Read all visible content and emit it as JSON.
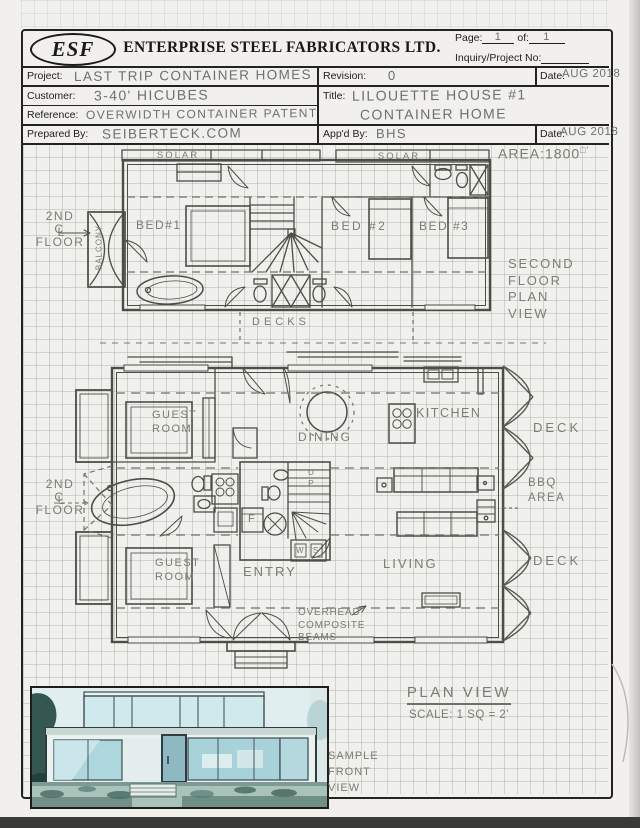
{
  "header": {
    "logo": "ESF",
    "company": "ENTERPRISE STEEL FABRICATORS LTD.",
    "page_label": "Page:",
    "page_value": "1",
    "of_label": "of:",
    "of_value": "1",
    "inquiry_label": "Inquiry/Project  No:"
  },
  "title_block": {
    "project_label": "Project:",
    "project_value": "LAST TRIP CONTAINER HOMES",
    "revision_label": "Revision:",
    "revision_value": "0",
    "date1_label": "Date:",
    "date1_value": "AUG 2018",
    "customer_label": "Customer:",
    "customer_value": "3-40' HICUBES",
    "title_label": "Title:",
    "title_line1": "LILOUETTE HOUSE #1",
    "title_line2": "CONTAINER HOME",
    "reference_label": "Reference:",
    "reference_value": "OVERWIDTH CONTAINER PATENT",
    "prepared_label": "Prepared By:",
    "prepared_value": "SEIBERTECK.COM",
    "approved_label": "App'd By:",
    "approved_value": "BHS",
    "date2_label": "Date:",
    "date2_value": "AUG 2018"
  },
  "second_floor": {
    "solar_left": "SOLAR",
    "solar_right": "SOLAR",
    "area_label": "AREA:1800",
    "area_unit": "□'",
    "marker": {
      "top": "2ND",
      "c": "C",
      "l": "L",
      "bottom": "FLOOR"
    },
    "balcony": "BALCONY",
    "bed1": "BED#1",
    "bed2": "BED #2",
    "bed3": "BED #3",
    "decks": "DECKS",
    "caption": [
      "SECOND",
      "FLOOR",
      "PLAN",
      "VIEW"
    ]
  },
  "first_floor": {
    "marker": {
      "top": "2ND",
      "c": "C",
      "l": "L",
      "bottom": "FLOOR"
    },
    "guest_top": [
      "GUEST",
      "ROOM"
    ],
    "dining": "DINING",
    "kitchen": "KITCHEN",
    "deck_upper": "DECK",
    "bbq": [
      "BBQ",
      "AREA"
    ],
    "deck_lower": "DECK",
    "guest_bottom": [
      "GUEST",
      "ROOM"
    ],
    "entry": "ENTRY",
    "living": "LIVING",
    "up": "UP",
    "fridge": "F",
    "washer": "W",
    "sink": "S",
    "beams": [
      "OVERHEAD",
      "COMPOSITE",
      "BEAMS"
    ]
  },
  "footer": {
    "plan_view": "PLAN VIEW",
    "scale": "SCALE: 1 SQ = 2'",
    "sample": [
      "SAMPLE",
      "FRONT",
      "VIEW"
    ]
  },
  "colors": {
    "pencil": "#4b4e46",
    "handwriting": "#6d716b",
    "ink": "#1e1e1c",
    "photo_tint": "#aed6dd"
  }
}
